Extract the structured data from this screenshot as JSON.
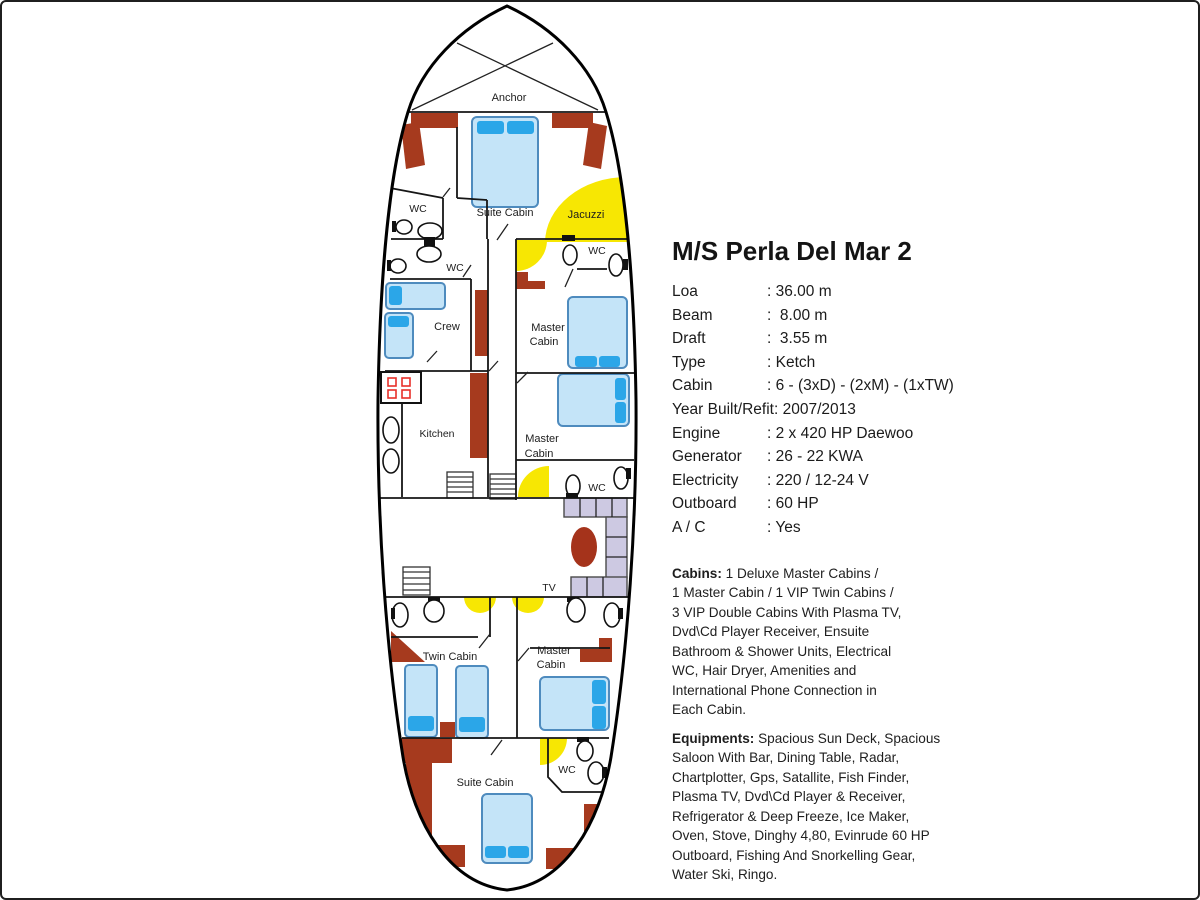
{
  "specs": {
    "title": "M/S Perla Del Mar 2",
    "rows": [
      {
        "label": "Loa",
        "value": ": 36.00 m"
      },
      {
        "label": "Beam",
        "value": ":  8.00 m"
      },
      {
        "label": "Draft",
        "value": ":  3.55 m"
      },
      {
        "label": "Type",
        "value": ": Ketch"
      },
      {
        "label": "Cabin",
        "value": ": 6 - (3xD) - (2xM) - (1xTW)"
      },
      {
        "label": "Year Built/Refit",
        "value": ": 2007/2013"
      },
      {
        "label": "Engine",
        "value": ": 2 x 420 HP Daewoo"
      },
      {
        "label": "Generator",
        "value": ": 26 - 22 KWA"
      },
      {
        "label": "Electricity",
        "value": ": 220 / 12-24 V"
      },
      {
        "label": "Outboard",
        "value": ": 60 HP"
      },
      {
        "label": "A / C",
        "value": ": Yes"
      }
    ]
  },
  "cabins": {
    "heading": "Cabins:",
    "body": "1 Deluxe Master Cabins /\n1 Master Cabin /  1 VIP Twin Cabins /\n3 VIP Double Cabins With Plasma TV,\nDvd\\Cd Player Receiver, Ensuite\nBathroom & Shower Units, Electrical\nWC, Hair Dryer, Amenities and\nInternational Phone Connection in\nEach Cabin."
  },
  "equipments": {
    "heading": "Equipments:",
    "body": "Spacious Sun Deck, Spacious\nSaloon With Bar, Dining Table, Radar,\nChartplotter, Gps, Satallite, Fish Finder,\nPlasma TV, Dvd\\Cd Player & Receiver,\nRefrigerator & Deep Freeze, Ice Maker,\nOven, Stove, Dinghy 4,80, Evinrude 60 HP\nOutboard, Fishing And Snorkelling Gear,\nWater Ski, Ringo."
  },
  "plan": {
    "labels": {
      "anchor": "Anchor",
      "suite_bow": "Suite Cabin",
      "jacuzzi": "Jacuzzi",
      "wc_bow_upper": "WC",
      "wc_bow_lower": "WC",
      "wc_master1": "WC",
      "crew": "Crew",
      "master1_line1": "Master",
      "master1_line2": "Cabin",
      "kitchen": "Kitchen",
      "master2_line1": "Master",
      "master2_line2": "Cabin",
      "wc_master2": "WC",
      "tv": "TV",
      "twin": "Twin Cabin",
      "master3_line1": "Master",
      "master3_line2": "Cabin",
      "wc_suite_aft": "WC",
      "suite_aft": "Suite Cabin"
    },
    "colors": {
      "wall_red": "#A63A1E",
      "bed_fill": "#C4E4F8",
      "bed_border": "#4E8BBE",
      "pillow_blue": "#2BA6E8",
      "shower_yellow": "#F7E703",
      "bench_gray": "#CDC9E2",
      "table_red": "#A5331B",
      "burner_red": "#E8302A"
    }
  }
}
